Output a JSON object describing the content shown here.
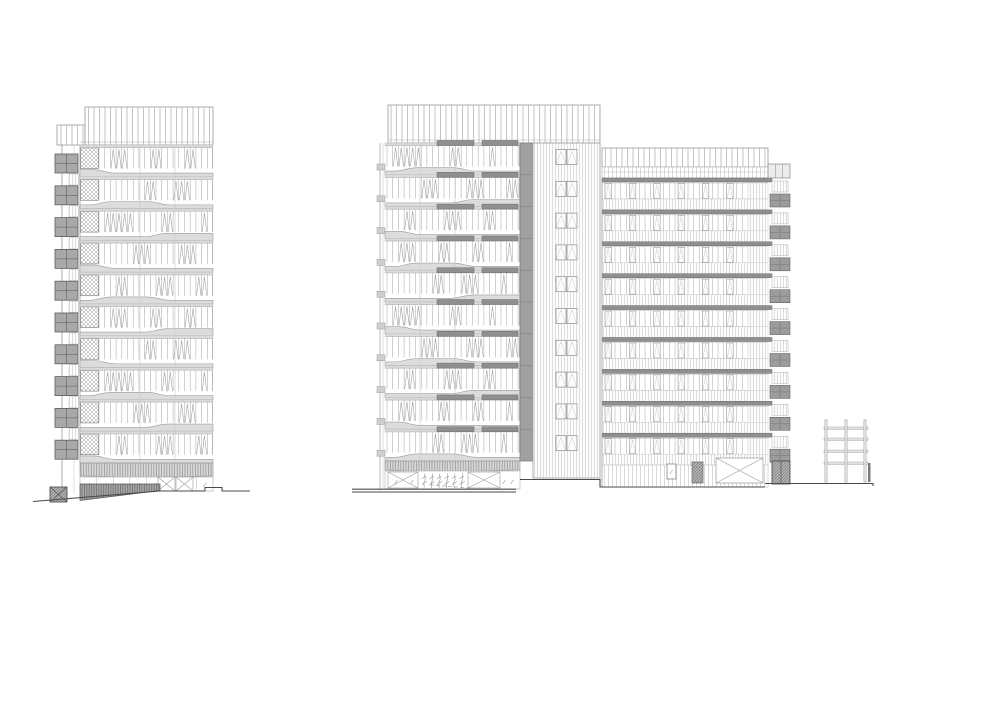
{
  "document": {
    "type": "architectural-elevation-drawing",
    "description": "Black-and-white architectural elevation line drawing: a slender 10-storey tower on the left and a wider composition on the right made of a 10-storey patterned tower, a vertically-striped stair core and a 9-storey annex block, with a small open site frame structure at far right",
    "background": "#ffffff",
    "text_labels": []
  },
  "palette": {
    "line_light": "#c6c6c6",
    "line_mid": "#9b9b9b",
    "line_dark": "#5f5f5f",
    "ground_line": "#4a4a4a",
    "slab_fill": "#8f8f8f",
    "strip_fill": "#a0a0a0",
    "band_fill": "#dcdcdc",
    "balcony_fill": "#a8a8a8",
    "glass_fill": "#fcfcfc",
    "dark_mass_fill": "#9a9a9a"
  },
  "left_tower": {
    "roof_screen": {
      "x": 85,
      "y": 107,
      "w": 128,
      "h": 38
    },
    "roof_step": {
      "x": 57,
      "y": 125,
      "w": 28,
      "h": 20
    },
    "facade": {
      "x": 80,
      "w": 133,
      "top": 145,
      "floors": 10,
      "floor_h": 31.8,
      "pier_w": 19,
      "cell_w": 5.7
    },
    "column_lines": [
      140,
      175
    ],
    "side_wall": {
      "x1": 62,
      "x2": 74,
      "x3": 80,
      "top": 145,
      "bottom": 493
    },
    "balcony": {
      "x": 55,
      "w": 23,
      "h": 19,
      "dy": 9,
      "strip_x": 69,
      "strip_w": 10,
      "strip_dy": 29,
      "strip_h": 11
    },
    "louver_band": {
      "y": 463,
      "h": 13
    },
    "ground_floor": {
      "x": 80,
      "w": 133,
      "y": 477,
      "h": 14,
      "panels": 8,
      "x_panels": [
        158,
        176
      ],
      "x_panel_w": 17
    },
    "retaining_wedge": {
      "x1": 80,
      "x2": 160,
      "y_top": 484,
      "y_right": 490.5,
      "y_left": 500.5
    },
    "corner_block": {
      "x": 50,
      "y": 487,
      "w": 17,
      "h": 15
    },
    "wave_cycle": [
      "dropEarly",
      "hump",
      "riseLate"
    ],
    "zigzag_sets": [
      [
        2,
        3,
        4,
        9,
        10,
        15,
        16,
        21
      ],
      [
        8,
        9,
        13,
        14,
        15,
        20
      ],
      [
        1,
        2,
        3,
        4,
        5,
        11,
        12,
        18
      ],
      [
        6,
        7,
        8,
        14,
        15,
        16,
        21,
        22
      ],
      [
        3,
        4,
        10,
        11,
        12,
        17,
        18
      ]
    ]
  },
  "middle_tower": {
    "roof_screen": {
      "x": 388,
      "y": 105,
      "w": 212,
      "h": 38
    },
    "facade": {
      "x": 385,
      "w": 135,
      "top": 143,
      "floors": 10,
      "floor_h": 31.8,
      "pier_w": 2,
      "cell_w": 5.7
    },
    "column_lines": [
      420,
      455
    ],
    "left_edge": {
      "x1": 380,
      "x2": 383,
      "tab_x": 377,
      "tab_w": 8,
      "tab_h": 6,
      "tab_dy": 21
    },
    "louver_bars": {
      "h": 5,
      "dy": -2.5,
      "bars": [
        [
          437,
          37
        ],
        [
          482,
          36
        ]
      ]
    },
    "dark_strip": {
      "x": 520,
      "w": 13,
      "top": 143,
      "bottom": 461
    },
    "core": {
      "x": 533,
      "w": 67,
      "top": 143,
      "bottom": 478,
      "win_x": 556,
      "win_w": 10,
      "win_h": 15,
      "win_dy": 6.5
    },
    "louver_band": {
      "y": 461,
      "h": 9
    },
    "ground_floor": {
      "x": 385,
      "w": 135,
      "y": 471,
      "h": 18,
      "x_panels": [
        [
          388,
          30
        ],
        [
          468,
          32
        ]
      ],
      "trees_x": 424,
      "trees_n": 6,
      "trees_step": 7.5
    },
    "wave_cycle": [
      "hump",
      "riseLate",
      "dropEarly"
    ],
    "zigzag_offset": 2
  },
  "right_block": {
    "screen": {
      "x": 602,
      "y": 148,
      "w": 166,
      "h": 19
    },
    "subband": {
      "y": 167,
      "h": 11
    },
    "facade": {
      "x": 602,
      "slab_w": 170,
      "win_w": 146,
      "top": 178,
      "floors": 9,
      "floor_h": 31.9,
      "slab_h": 4,
      "units": 6
    },
    "pier": {
      "x": 748,
      "w": 20
    },
    "ground": {
      "x": 602,
      "y": 465,
      "w": 166,
      "h": 22,
      "door": {
        "x": 667,
        "y": 464,
        "w": 9,
        "h": 15
      },
      "hatch_door": {
        "x": 692,
        "y": 462,
        "w": 11,
        "h": 21
      },
      "x_panel": {
        "x": 716,
        "y": 458,
        "w": 47,
        "h": 25
      },
      "corner_block": {
        "x": 772,
        "y": 461,
        "w": 18,
        "h": 23
      }
    },
    "balcony": {
      "dark_x": 770,
      "dark_w": 20,
      "dark_dy": 16,
      "dark_h": 13,
      "light_x": 772,
      "light_w": 16,
      "light_dy": 3,
      "light_h": 11,
      "top_block": {
        "x": 768,
        "y": 164,
        "w": 22,
        "h": 14
      }
    }
  },
  "site_frame": {
    "posts": [
      825,
      845,
      864
    ],
    "post_w": 2,
    "top": 420,
    "bottom": 482,
    "beams": [
      427,
      438,
      450,
      462
    ],
    "beam_x": 824,
    "beam_w": 44,
    "stub": {
      "x": 868,
      "y": 463,
      "w": 2.5,
      "h": 19
    }
  },
  "ground": {
    "segments": [
      "M33,501.5 L160,491 L205,491",
      "M205,491 L205,487.5 L222,487.5 L222,491 L250,491",
      "M352,489.2 L516,489.2",
      "M352,492 L516,492",
      "M520,479.5 L600,479.5 L600,487 L765,487",
      "M765,483.5 L873,483.5 L873,486"
    ]
  }
}
